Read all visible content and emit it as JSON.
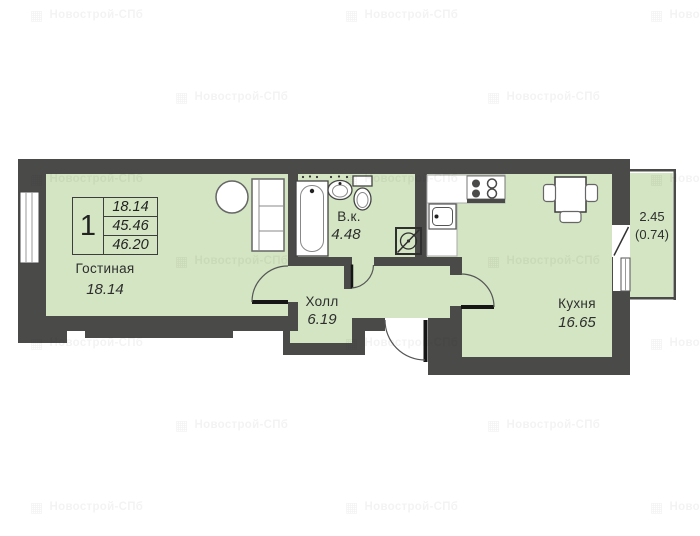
{
  "watermark": {
    "text": "Новострой-СПб",
    "icon": "building-icon"
  },
  "info_table": {
    "room_count": "1",
    "rows": [
      "18.14",
      "45.46",
      "46.20"
    ]
  },
  "rooms": {
    "living": {
      "name": "Гостиная",
      "area": "18.14"
    },
    "bathroom": {
      "name": "В.к.",
      "area": "4.48"
    },
    "hall": {
      "name": "Холл",
      "area": "6.19"
    },
    "kitchen": {
      "name": "Кухня",
      "area": "16.65"
    },
    "balcony": {
      "area": "2.45",
      "area_reduced": "(0.74)"
    }
  },
  "colors": {
    "wall": "#4a4a49",
    "room_fill": "#d3e5c2",
    "fixture_stroke": "#555555",
    "door_leaf": "#161616",
    "page_bg": "#ffffff"
  }
}
